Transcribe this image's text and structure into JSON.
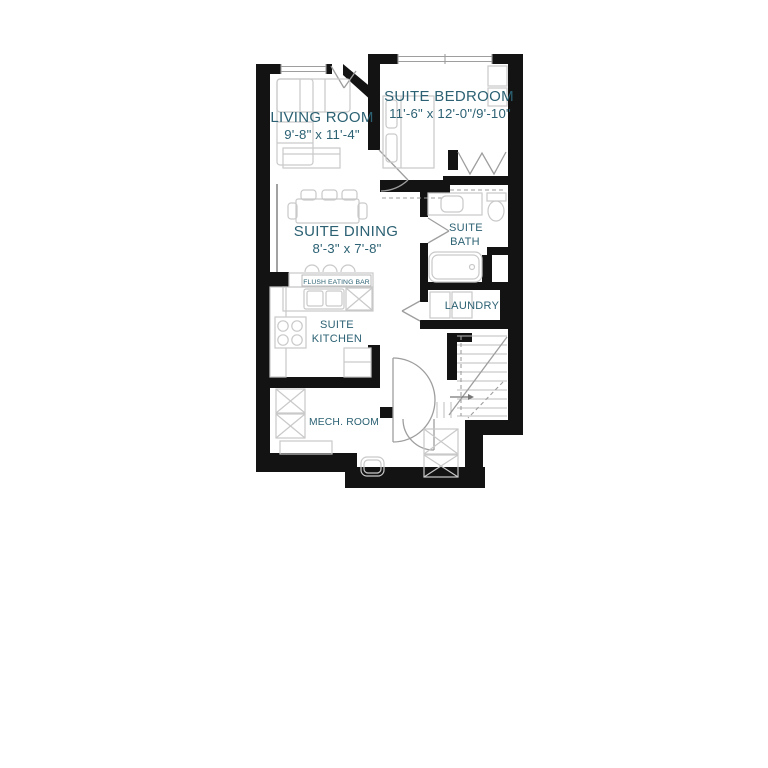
{
  "colors": {
    "wall": "#131313",
    "label": "#2b6173",
    "fixture": "#c9c9c9",
    "door": "#9e9e9e",
    "window": "#9e9e9e",
    "stair_tread": "#bdbdbd"
  },
  "rooms": {
    "living_room": {
      "name": "LIVING ROOM",
      "dims": "9'-8\" x 11'-4\""
    },
    "suite_bedroom": {
      "name": "SUITE BEDROOM",
      "dims": "11'-6\" x 12'-0\"/9'-10\""
    },
    "suite_dining": {
      "name": "SUITE DINING",
      "dims": "8'-3\" x 7'-8\""
    },
    "suite_kitchen": {
      "name_line1": "SUITE",
      "name_line2": "KITCHEN"
    },
    "suite_bath": {
      "name_line1": "SUITE",
      "name_line2": "BATH"
    },
    "laundry": {
      "name": "LAUNDRY"
    },
    "mech_room": {
      "name": "MECH. ROOM"
    },
    "eating_bar": {
      "label": "FLUSH EATING BAR"
    }
  }
}
